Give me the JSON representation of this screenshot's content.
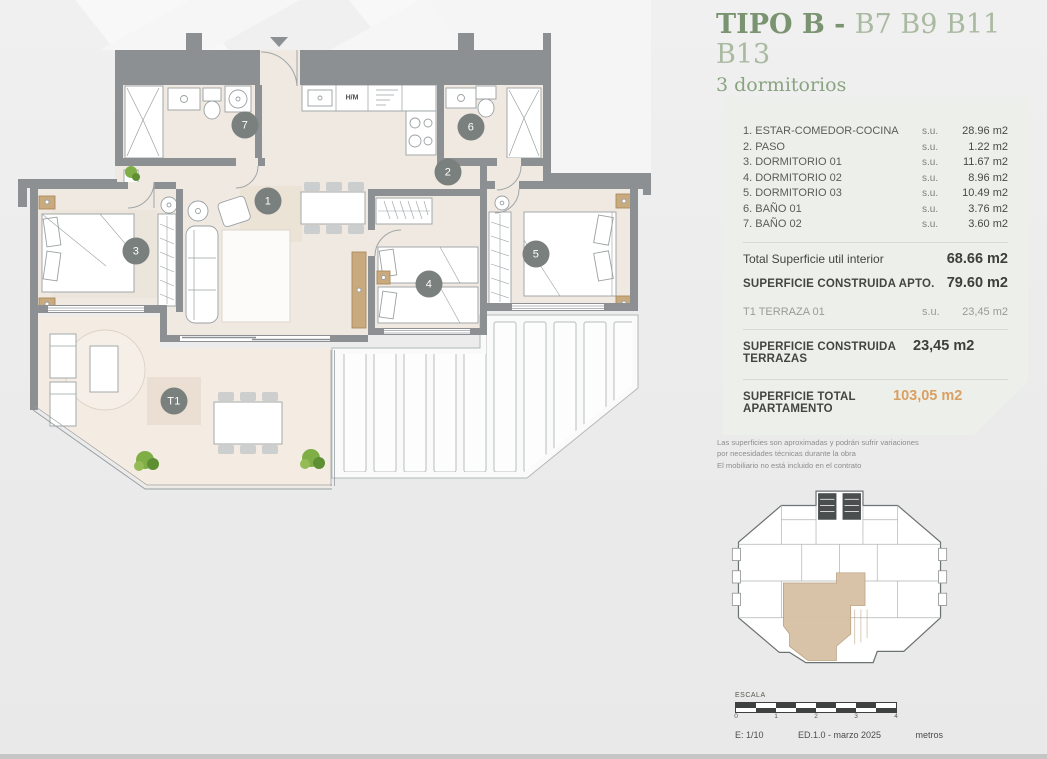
{
  "title": {
    "type_label": "TIPO B - ",
    "units": "B7 B9 B11 B13",
    "subtitle": "3 dormitorios"
  },
  "area_table": {
    "su_prefix": "s.u.",
    "rows": [
      {
        "label": "1. ESTAR-COMEDOR-COCINA",
        "value": "28.96 m2"
      },
      {
        "label": "2. PASO",
        "value": "1.22 m2"
      },
      {
        "label": "3. DORMITORIO 01",
        "value": "11.67 m2"
      },
      {
        "label": "4. DORMITORIO 02",
        "value": "8.96 m2"
      },
      {
        "label": "5. DORMITORIO 03",
        "value": "10.49 m2"
      },
      {
        "label": "6. BAÑO 01",
        "value": "3.76 m2"
      },
      {
        "label": "7. BAÑO 02",
        "value": "3.60 m2"
      }
    ],
    "total_util": {
      "label": "Total Superficie util interior",
      "value": "68.66 m2"
    },
    "construida_apto": {
      "label": "SUPERFICIE CONSTRUIDA APTO.",
      "value": "79.60 m2"
    },
    "terraza": {
      "label": "T1 TERRAZA 01",
      "value": "23,45 m2"
    },
    "construida_terrazas": {
      "label": "SUPERFICIE CONSTRUIDA TERRAZAS",
      "value": "23,45 m2"
    },
    "total_apartamento": {
      "label": "SUPERFICIE TOTAL APARTAMENTO",
      "value": "103,05 m2"
    }
  },
  "disclaimer": {
    "line1": "Las superficies son aproximadas y podrán sufrir variaciones",
    "line2": "por necesidades técnicas durante la obra",
    "line3": "El mobiliario no está incluido en el contrato"
  },
  "plan": {
    "kitchen_label": "H/M",
    "badges": [
      {
        "label": "1",
        "x": 268,
        "y": 201
      },
      {
        "label": "2",
        "x": 448,
        "y": 172
      },
      {
        "label": "3",
        "x": 136,
        "y": 251
      },
      {
        "label": "4",
        "x": 429,
        "y": 284
      },
      {
        "label": "5",
        "x": 536,
        "y": 254
      },
      {
        "label": "6",
        "x": 471,
        "y": 127
      },
      {
        "label": "7",
        "x": 245,
        "y": 125
      },
      {
        "label": "T1",
        "x": 174,
        "y": 401
      }
    ]
  },
  "scale": {
    "label": "ESCALA",
    "ticks": [
      "0",
      "1",
      "2",
      "3",
      "4"
    ],
    "left": "E: 1/10",
    "center": "ED.1.0 - marzo 2025",
    "right": "metros"
  },
  "colors": {
    "accent_green": "#7a9370",
    "light_green": "#a9baa1",
    "orange_total": "#d99f63",
    "panel_bg": "#edf0ea",
    "wall_gray": "#8d9092",
    "badge_gray": "#7a807d",
    "floor_beige": "#f0e9e2",
    "terrace_beige": "#f4ece3",
    "wood_tan": "#c9aa7e",
    "plant_green": "#7fae46"
  }
}
